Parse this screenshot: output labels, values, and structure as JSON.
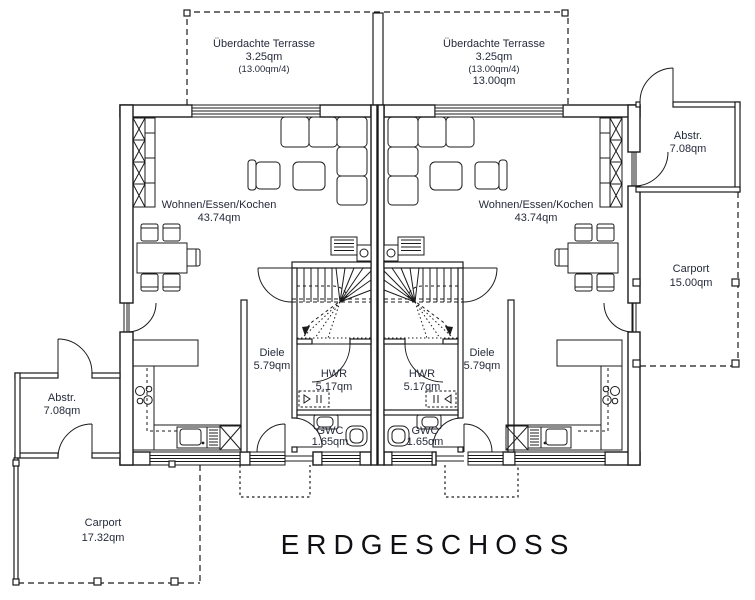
{
  "plan_title": "ERDGESCHOSS",
  "rooms": {
    "terrace_left": {
      "name": "Überdachte Terrasse",
      "area": "3.25qm",
      "note": "(13.00qm/4)"
    },
    "terrace_right": {
      "name": "Überdachte Terrasse",
      "area": "3.25qm",
      "note": "(13.00qm/4)",
      "total": "13.00qm"
    },
    "living_left": {
      "name": "Wohnen/Essen/Kochen",
      "area": "43.74qm"
    },
    "living_right": {
      "name": "Wohnen/Essen/Kochen",
      "area": "43.74qm"
    },
    "diele_left": {
      "name": "Diele",
      "area": "5.79qm"
    },
    "diele_right": {
      "name": "Diele",
      "area": "5.79qm"
    },
    "hwr_left": {
      "name": "HWR",
      "area": "5.17qm"
    },
    "hwr_right": {
      "name": "HWR",
      "area": "5.17qm"
    },
    "gwc_left": {
      "name": "GWC",
      "area": "1.65qm"
    },
    "gwc_right": {
      "name": "GWC",
      "area": "1.65qm"
    },
    "abstr_left": {
      "name": "Abstr.",
      "area": "7.08qm"
    },
    "abstr_right": {
      "name": "Abstr.",
      "area": "7.08qm"
    },
    "carport_left": {
      "name": "Carport",
      "area": "17.32qm"
    },
    "carport_right": {
      "name": "Carport",
      "area": "15.00qm"
    }
  },
  "colors": {
    "line": "#1b1b1b",
    "label": "#262b3b",
    "title": "#101014"
  }
}
